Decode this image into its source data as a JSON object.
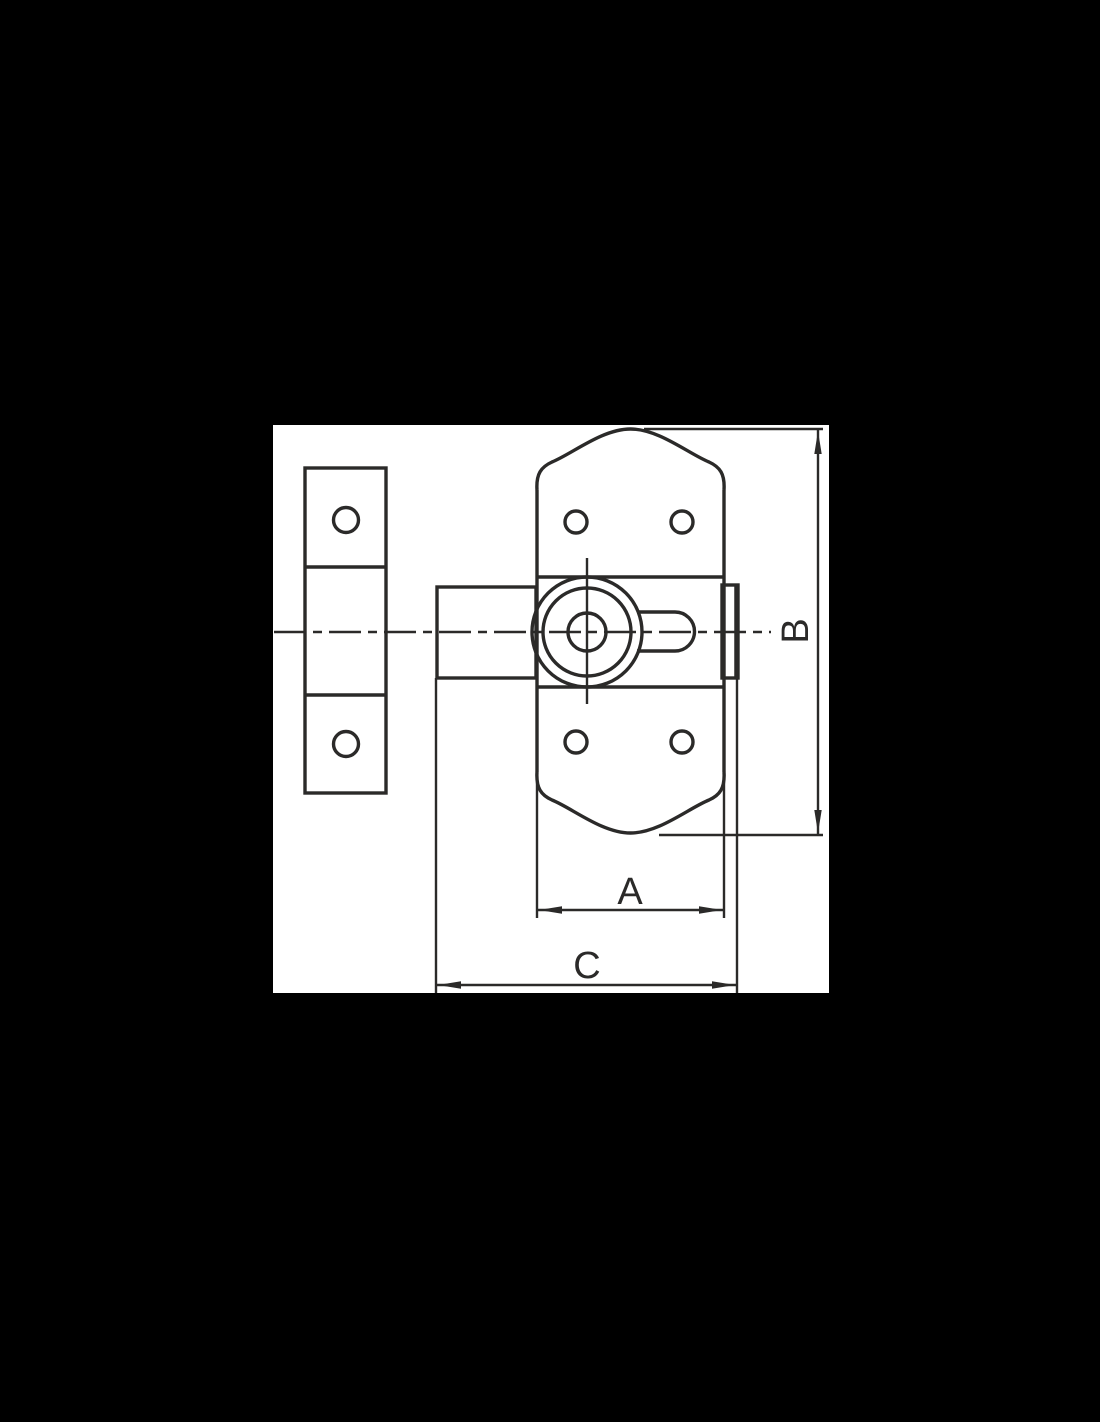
{
  "title": "lock bolt technical drawing",
  "colors": {
    "page_background": "#000000",
    "panel_background": "#ffffff",
    "line_color": "#2b2a29"
  },
  "dimensions": {
    "width_label": "A",
    "height_label": "B",
    "total_width_label": "C"
  }
}
